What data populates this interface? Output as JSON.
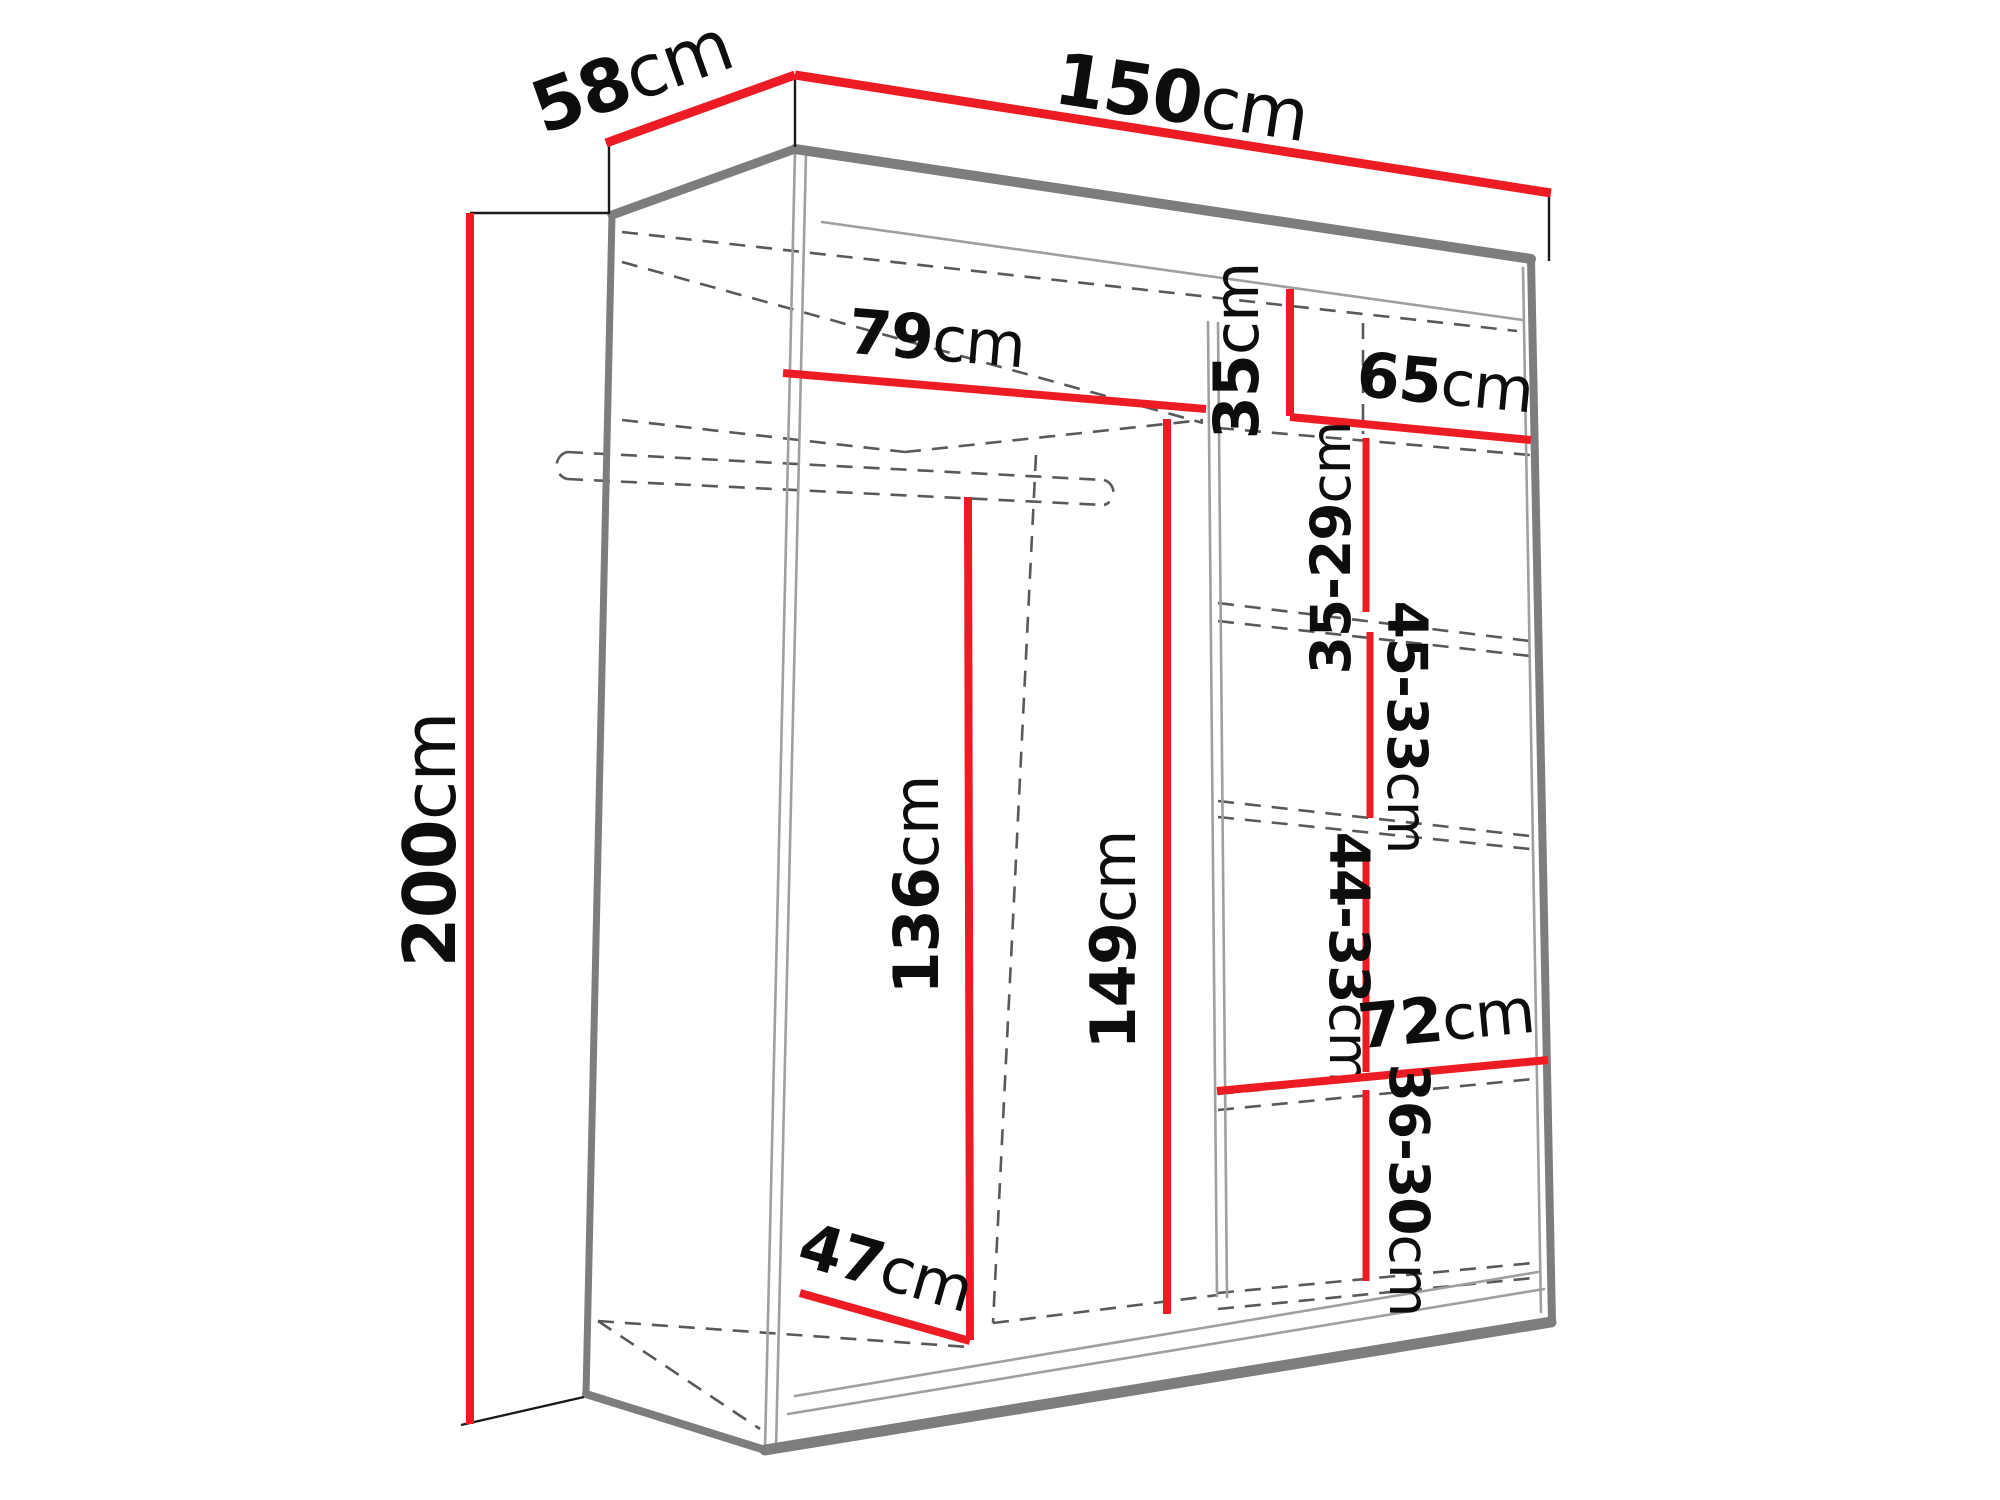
{
  "diagram": {
    "title": "wardrobe-dimension-diagram",
    "unit": "cm",
    "colors": {
      "dimension_red": "#ED1C24",
      "edge_gray": "#7d7d7d",
      "hidden_gray": "#595959",
      "label_black": "#0d0d0d",
      "background": "#ffffff"
    },
    "dimensions": {
      "height": {
        "num": "200",
        "unit": "cm"
      },
      "depth": {
        "num": "58",
        "unit": "cm"
      },
      "width": {
        "num": "150",
        "unit": "cm"
      },
      "left_section_width": {
        "num": "79",
        "unit": "cm"
      },
      "right_section_width": {
        "num": "65",
        "unit": "cm"
      },
      "top_shelf_height": {
        "num": "35",
        "unit": "cm"
      },
      "shelf_gap_1": {
        "num": "35-29",
        "unit": "cm"
      },
      "shelf_gap_2": {
        "num": "45-33",
        "unit": "cm"
      },
      "shelf_gap_3": {
        "num": "44-33",
        "unit": "cm"
      },
      "shelf_gap_4": {
        "num": "36-30",
        "unit": "cm"
      },
      "hanging_height": {
        "num": "136",
        "unit": "cm"
      },
      "right_column_height": {
        "num": "149",
        "unit": "cm"
      },
      "bottom_shelf_width": {
        "num": "72",
        "unit": "cm"
      },
      "floor_depth": {
        "num": "47",
        "unit": "cm"
      }
    }
  }
}
